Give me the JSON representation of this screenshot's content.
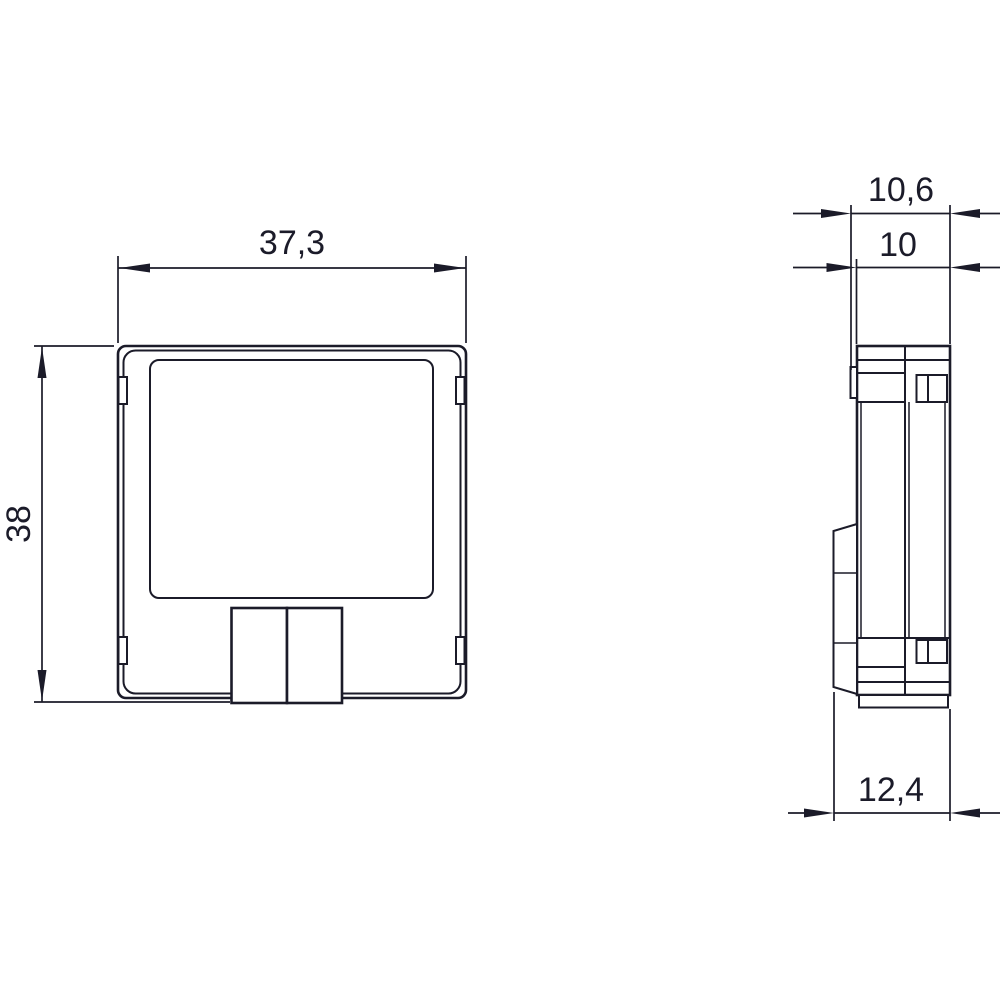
{
  "drawing": {
    "background": "#ffffff",
    "line_color": "#1b1b29",
    "views": {
      "front": {
        "label": "front-view"
      },
      "side": {
        "label": "side-view"
      }
    },
    "dimensions": {
      "front_width": "37,3",
      "front_height": "38",
      "side_depth_overall": "10,6",
      "side_depth_body": "10",
      "side_depth_bottom": "12,4"
    }
  }
}
